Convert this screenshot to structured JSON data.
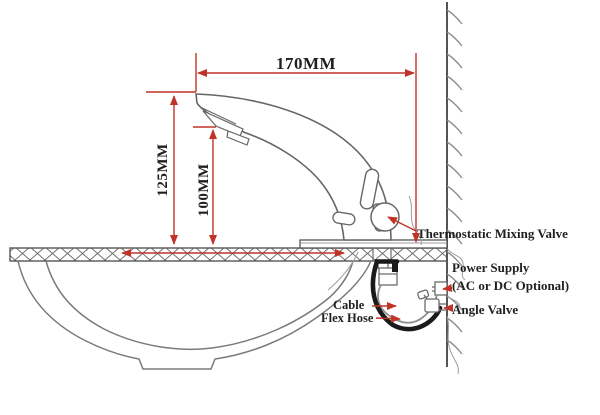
{
  "diagram": {
    "dimensions": {
      "spout_reach": "170MM",
      "spout_height": "125MM",
      "outlet_height": "100MM"
    },
    "callouts": {
      "thermostatic": "Thermostatic Mixing Valve",
      "power_supply": "Power Supply",
      "power_supply_option": "(AC or DC Optional)",
      "angle_valve": "Angle Valve",
      "cable": "Cable",
      "flex_hose": "Flex Hose"
    },
    "colors": {
      "dimension_red": "#c03428",
      "drawing_gray": "#6b6b6b",
      "hose_black": "#1a1a1a",
      "text": "#1f1f1f",
      "background": "#ffffff"
    }
  }
}
